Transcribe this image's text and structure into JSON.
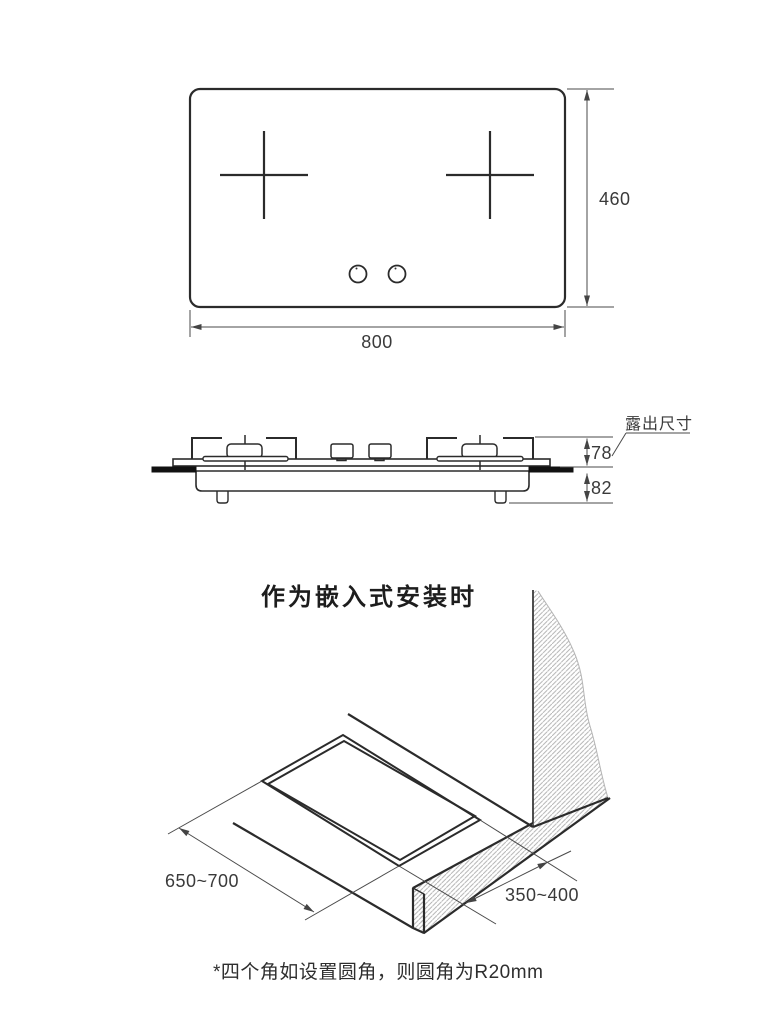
{
  "top_view": {
    "width_label": "800",
    "height_label": "460"
  },
  "side_view": {
    "exposed_label": "露出尺寸",
    "above_counter_label": "78",
    "below_counter_label": "82"
  },
  "install_view": {
    "title": "作为嵌入式安装时",
    "cutout_width_label": "650~700",
    "cutout_depth_label": "350~400",
    "note": "*四个角如设置圆角，则圆角为R20mm"
  },
  "colors": {
    "line": "#2b2b2b",
    "thin_line": "#4a4a4a",
    "hatch": "#b0b0b0",
    "counter_fill": "#111111"
  }
}
